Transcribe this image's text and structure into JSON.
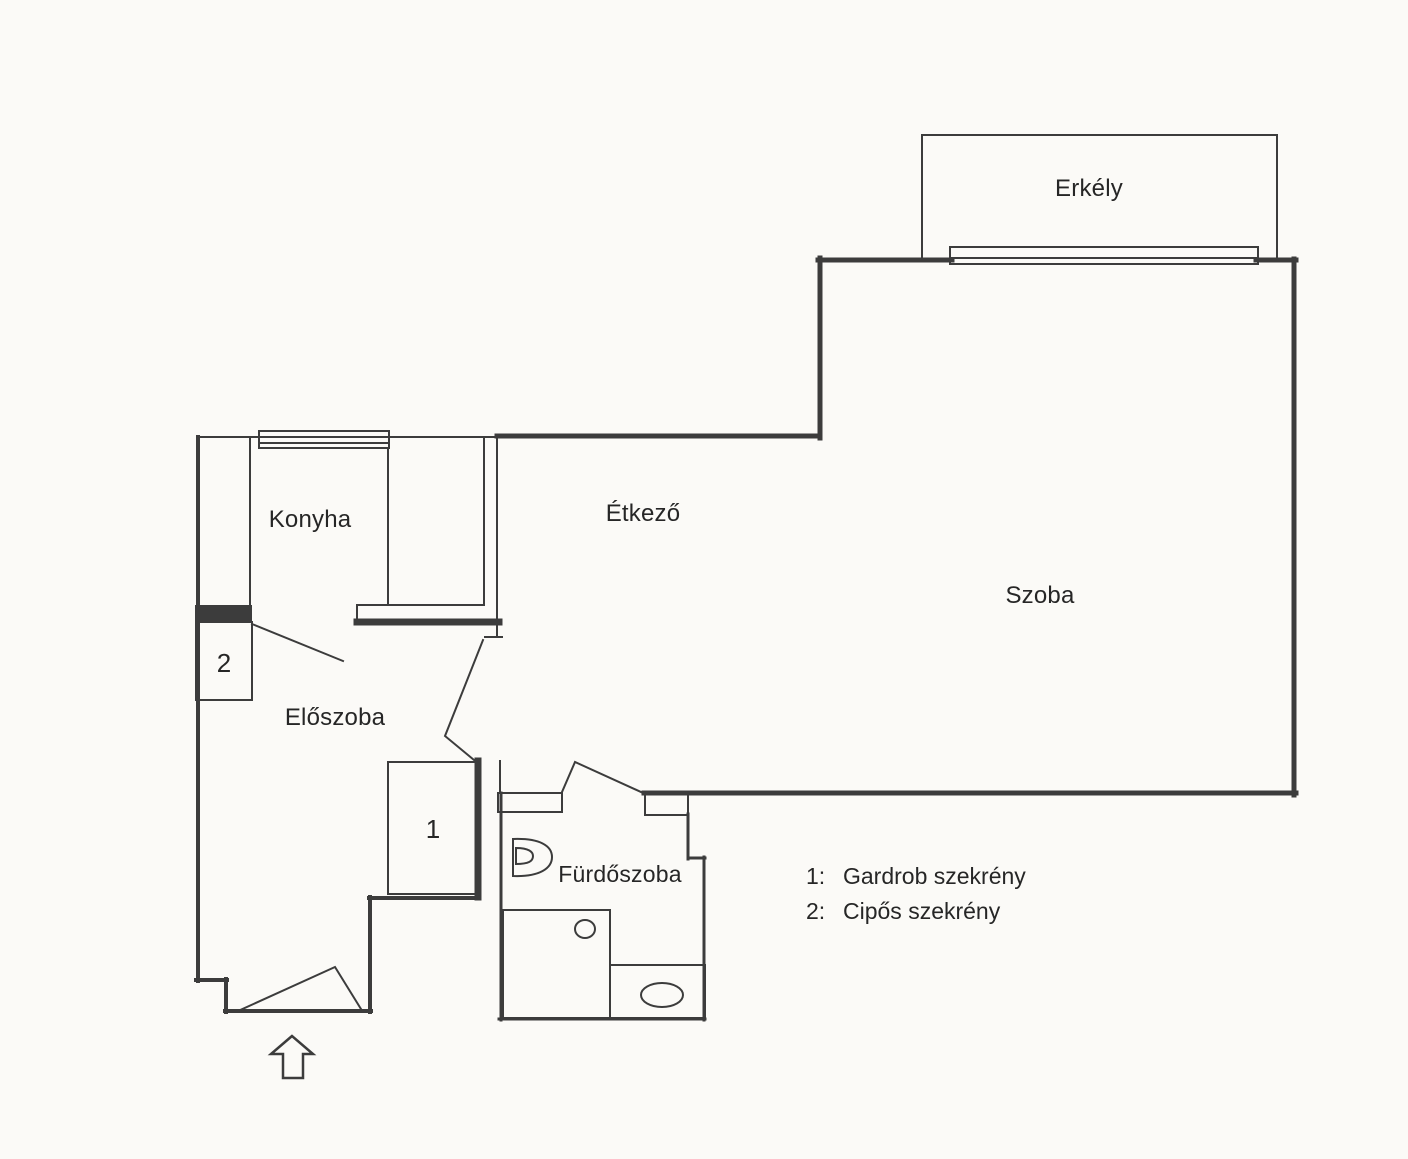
{
  "plan": {
    "background": "#fbfaf7",
    "line_color": "#3c3c3c",
    "text_color": "#262626",
    "rooms": {
      "erkely": "Erkély",
      "szoba": "Szoba",
      "etkezo": "Étkező",
      "konyha": "Konyha",
      "eloszoba": "Előszoba",
      "furdoszoba": "Fürdőszoba"
    },
    "markers": {
      "wardrobe": "1",
      "shoe_cabinet": "2"
    },
    "legend": {
      "items": [
        {
          "key": "1:",
          "label": "Gardrob szekrény"
        },
        {
          "key": "2:",
          "label": "Cipős szekrény"
        }
      ]
    }
  }
}
